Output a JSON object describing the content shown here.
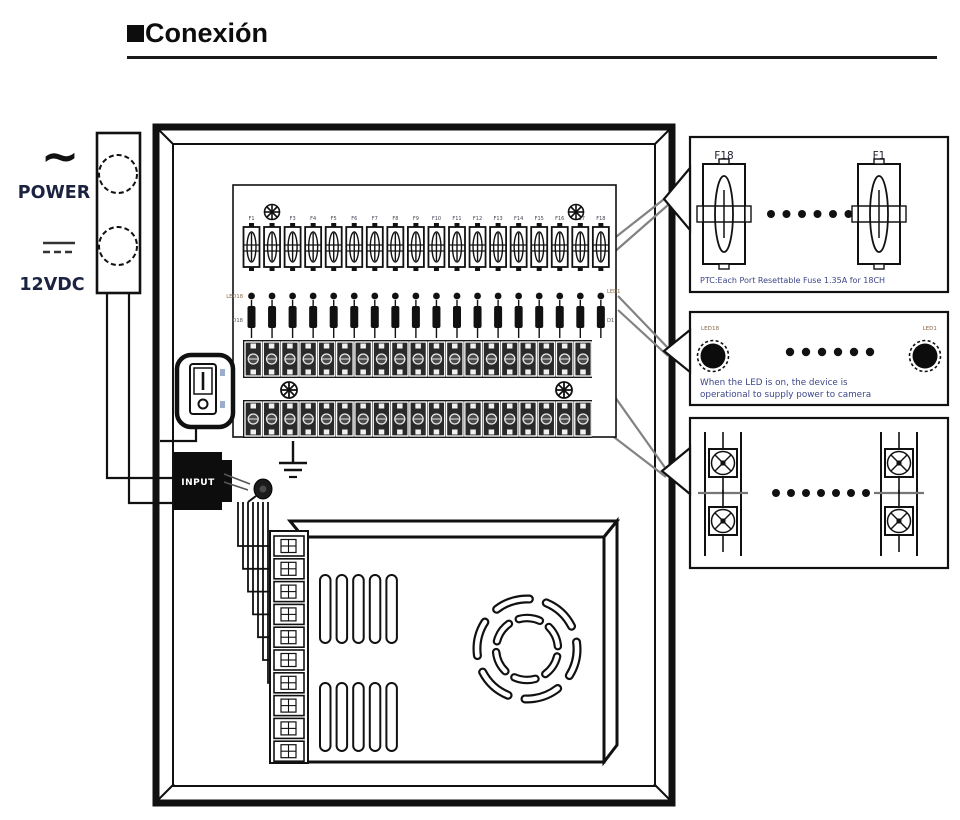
{
  "title": {
    "text": "Conexión"
  },
  "power_panel": {
    "ac_symbol": "~",
    "ac_label": "POWER",
    "dc_label": "12VDC"
  },
  "enclosure": {
    "input_label": "INPUT"
  },
  "board": {
    "fuse_labels": [
      "F1",
      "F2",
      "F3",
      "F4",
      "F5",
      "F6",
      "F7",
      "F8",
      "F9",
      "F10",
      "F11",
      "F12",
      "F13",
      "F14",
      "F15",
      "F16",
      "F17",
      "F18"
    ],
    "fuse_count": 18,
    "led_count": 18,
    "terminal_cells": 19,
    "led_row": {
      "left": "LED18",
      "right": "LED1"
    },
    "diode_row": {
      "left": "D18",
      "right": "D1"
    }
  },
  "psu": {
    "terminal_count": 10,
    "vent_slots": 5,
    "vent_groups": 2
  },
  "wiring": {
    "staircase_wires": 7
  },
  "callouts": {
    "fuse": {
      "left": "F18",
      "right": "F1",
      "dots": 6,
      "caption": "PTC:Each Port Resettable Fuse 1.35A for 18CH"
    },
    "led": {
      "left": "LED18",
      "right": "LED1",
      "dots": 6,
      "caption1": "When the LED is on, the device is",
      "caption2": "operational to supply power to camera"
    },
    "terminal": {
      "dots": 7
    }
  },
  "colors": {
    "ink": "#111111",
    "leader": "#828282",
    "caption": "#3c4788",
    "label": "#1c2340"
  }
}
